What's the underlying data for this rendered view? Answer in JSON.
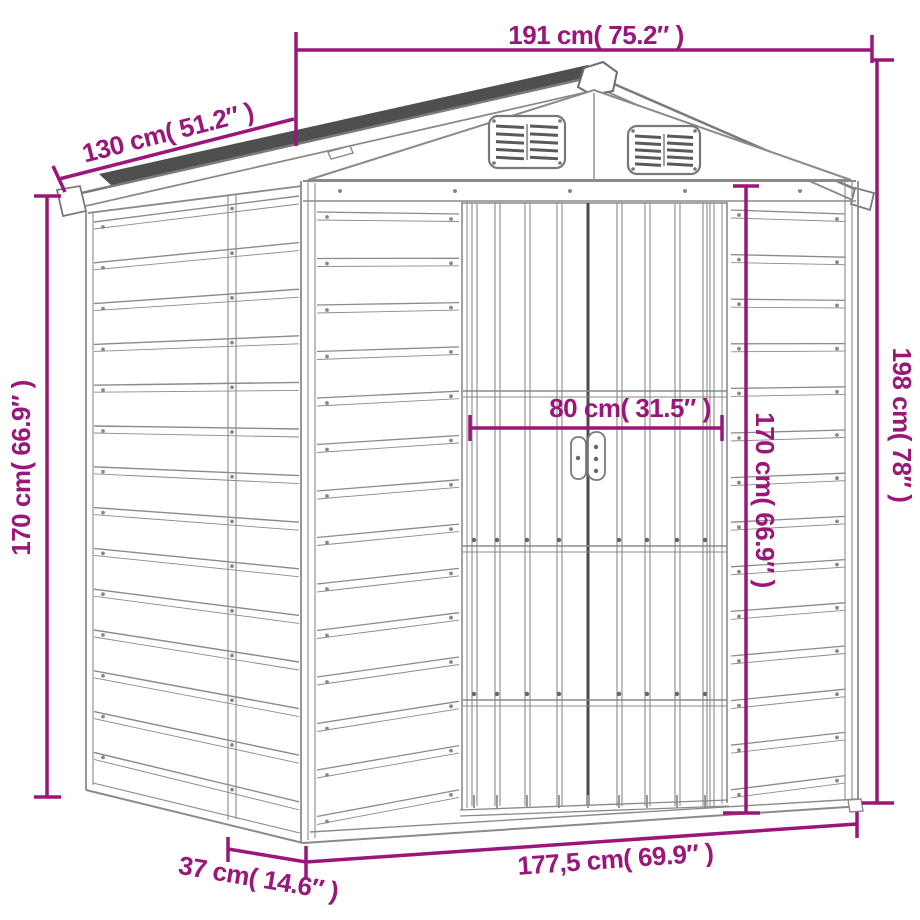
{
  "figure": {
    "title": "Garden metal shed dimension diagram",
    "accent_color": "#9a1679",
    "drawing_color": "#8a8a8a"
  },
  "dimensions": {
    "roof_width": {
      "label": "191 cm( 75.2″ )"
    },
    "roof_depth": {
      "label": "130 cm( 51.2″ )"
    },
    "wall_height_left": {
      "label": "170 cm( 66.9″ )"
    },
    "total_height": {
      "label": "198 cm( 78″ )"
    },
    "door_width": {
      "label": "80 cm( 31.5″ )"
    },
    "wall_height_front": {
      "label": "170 cm( 66.9″ )"
    },
    "base_width": {
      "label": "177,5 cm( 69.9″ )"
    },
    "base_depth": {
      "label": "37 cm( 14.6″ )"
    }
  }
}
